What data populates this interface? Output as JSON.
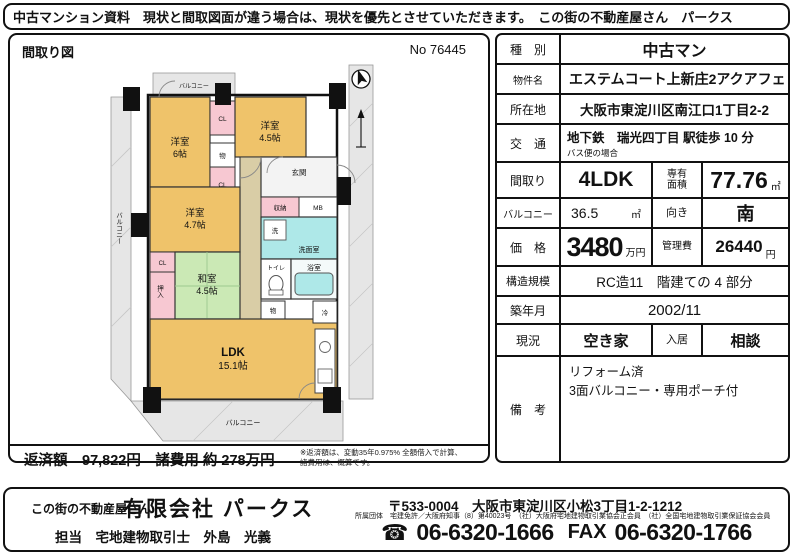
{
  "top_bar": {
    "text": "中古マンション資料　現状と間取図面が違う場合は、現状を優先とさせていただきます。　この街の不動産屋さん　パークス"
  },
  "floorplan_panel": {
    "title": "間取り図",
    "no": "No 76445",
    "repayment": "返済額　97,822円　諸費用 約 278万円",
    "note_line1": "※返済額は、変動35年0.975% 全額借入で計算、",
    "note_line2": "諸費用は、概算です。"
  },
  "floorplan": {
    "rooms": {
      "west1_name": "洋室",
      "west1_size": "6帖",
      "west2_name": "洋室",
      "west2_size": "4.5帖",
      "west3_name": "洋室",
      "west3_size": "4.7帖",
      "tatami_name": "和室",
      "tatami_size": "4.5帖",
      "ldk_name": "LDK",
      "ldk_size": "15.1帖"
    },
    "labels": {
      "balcony_top": "バルコニー",
      "balcony_left": "バルコニー",
      "balcony_bottom": "バルコニー",
      "genkan": "玄関",
      "shuno": "収納",
      "mb": "MB",
      "sen": "洗",
      "senmen": "洗面室",
      "toilet": "トイレ",
      "bath": "浴室",
      "mono1": "物",
      "mono2": "物",
      "rei": "冷",
      "cl1": "CL",
      "cl2": "CL",
      "cl3": "CL",
      "oshiire": "押入"
    },
    "colors": {
      "room_orange": "#EFC36A",
      "tatami_green": "#CBE9B5",
      "water_cyan": "#AEE8E8",
      "closet_pink": "#F7C8D2",
      "hall_beige": "#D9CDA6",
      "balcony_gray": "#E6E6E6"
    }
  },
  "property_table": {
    "rows": {
      "type": {
        "label": "種　別",
        "value": "中古マン"
      },
      "name": {
        "label": "物件名",
        "value": "エステムコート上新庄2アクアフェ"
      },
      "address": {
        "label": "所在地",
        "value": "大阪市東淀川区南江口1丁目2-2"
      },
      "access": {
        "label": "交　通",
        "value": "地下鉄　瑞光四丁目 駅徒歩 10 分",
        "sub": "バス便の場合"
      },
      "layout": {
        "label": "間取り",
        "value": "4LDK",
        "label2a": "専有",
        "label2b": "面積",
        "value2": "77.76",
        "unit2": "㎡"
      },
      "balcony": {
        "label": "バルコニー",
        "value": "36.5",
        "unit": "㎡",
        "label2": "向き",
        "value2": "南"
      },
      "price": {
        "label": "価　格",
        "value": "3480",
        "unit": "万円",
        "label2": "管理費",
        "value2": "26440",
        "unit2": "円"
      },
      "structure": {
        "label": "構造規模",
        "value": "RC造11　階建ての 4 部分"
      },
      "built": {
        "label": "築年月",
        "value": "2002/11"
      },
      "status": {
        "label": "現況",
        "value": "空き家",
        "label2": "入居",
        "value2": "相談"
      },
      "remarks": {
        "label": "備　考",
        "line1": "リフォーム済",
        "line2": "3面バルコニー・専用ポーチ付"
      }
    }
  },
  "footer": {
    "tagline": "この街の不動産屋さん",
    "company": "有限会社 パークス",
    "postal": "〒533-0004　大阪市東淀川区小松3丁目1-2-1212",
    "association": "所属団体　宅建免許／大阪府知事（8）第40023号　（社）大阪府宅地建物取引業協会正会員　（社）全国宅地建物取引業保証協会会員",
    "agent": "担当　宅地建物取引士　外島　光義",
    "phone_icon": "☎",
    "tel": "06-6320-1666",
    "fax_label": "FAX",
    "fax": "06-6320-1766"
  }
}
